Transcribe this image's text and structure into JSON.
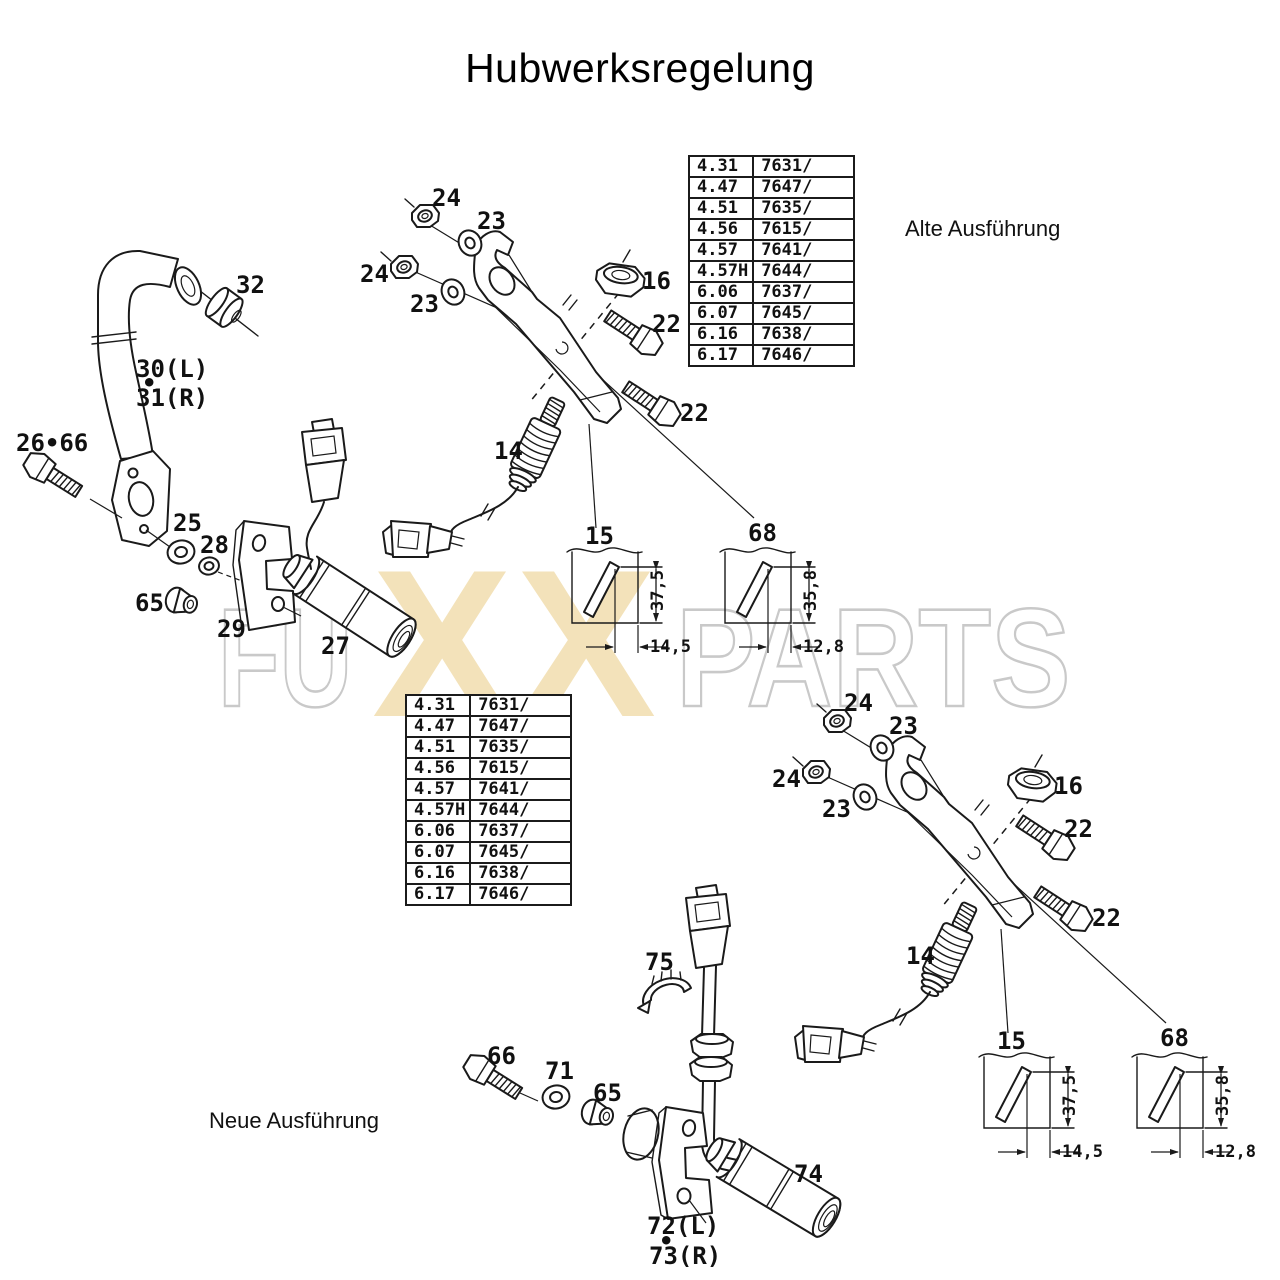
{
  "title": "Hubwerksregelung",
  "annotations": {
    "old_version": "Alte Ausführung",
    "new_version": "Neue Ausführung"
  },
  "variant_table": {
    "rows": [
      [
        "4.31",
        "7631/"
      ],
      [
        "4.47",
        "7647/"
      ],
      [
        "4.51",
        "7635/"
      ],
      [
        "4.56",
        "7615/"
      ],
      [
        "4.57",
        "7641/"
      ],
      [
        "4.57H",
        "7644/"
      ],
      [
        "6.06",
        "7637/"
      ],
      [
        "6.07",
        "7645/"
      ],
      [
        "6.16",
        "7638/"
      ],
      [
        "6.17",
        "7646/"
      ]
    ]
  },
  "watermark": {
    "left": "FU",
    "mid1": "X",
    "mid2": "X",
    "right": "PARTS",
    "tan": "#f3e2ba",
    "gray": "#c9c9c9"
  },
  "line_color": "#1a1a1a",
  "assembly_callouts": [
    {
      "t": "24",
      "x": 432,
      "y": 206,
      "name": "callout-24"
    },
    {
      "t": "23",
      "x": 477,
      "y": 229,
      "name": "callout-23"
    },
    {
      "t": "24",
      "x": 360,
      "y": 282,
      "name": "callout-24"
    },
    {
      "t": "23",
      "x": 410,
      "y": 312,
      "name": "callout-23"
    },
    {
      "t": "16",
      "x": 642,
      "y": 289,
      "name": "callout-16"
    },
    {
      "t": "22",
      "x": 652,
      "y": 332,
      "name": "callout-22"
    },
    {
      "t": "22",
      "x": 680,
      "y": 421,
      "name": "callout-22"
    },
    {
      "t": "14",
      "x": 494,
      "y": 459,
      "name": "callout-14"
    },
    {
      "t": "15",
      "x": 585,
      "y": 544,
      "name": "callout-15"
    },
    {
      "t": "68",
      "x": 748,
      "y": 541,
      "name": "callout-68"
    },
    {
      "t": "37,5",
      "x": 663,
      "y": 611,
      "rot": -90,
      "cls": "dim",
      "name": "dim-37-5"
    },
    {
      "t": "14,5",
      "x": 650,
      "y": 652,
      "cls": "dim",
      "name": "dim-14-5"
    },
    {
      "t": "35,8",
      "x": 816,
      "y": 611,
      "rot": -90,
      "cls": "dim",
      "name": "dim-35-8"
    },
    {
      "t": "12,8",
      "x": 803,
      "y": 652,
      "cls": "dim",
      "name": "dim-12-8"
    }
  ],
  "global_callouts": [
    {
      "t": "32",
      "x": 236,
      "y": 293,
      "name": "callout-32"
    },
    {
      "t": "30(L)",
      "x": 136,
      "y": 377,
      "name": "callout-30L"
    },
    {
      "t": "•",
      "x": 142,
      "y": 391,
      "name": "callout-dot"
    },
    {
      "t": "31(R)",
      "x": 136,
      "y": 406,
      "name": "callout-31R"
    },
    {
      "t": "26•66",
      "x": 16,
      "y": 451,
      "name": "callout-26-66"
    },
    {
      "t": "25",
      "x": 173,
      "y": 531,
      "name": "callout-25"
    },
    {
      "t": "28",
      "x": 200,
      "y": 553,
      "name": "callout-28"
    },
    {
      "t": "65",
      "x": 135,
      "y": 611,
      "name": "callout-65"
    },
    {
      "t": "29",
      "x": 217,
      "y": 637,
      "name": "callout-29"
    },
    {
      "t": "27",
      "x": 321,
      "y": 654,
      "name": "callout-27"
    },
    {
      "t": "75",
      "x": 645,
      "y": 970,
      "name": "callout-75"
    },
    {
      "t": "66",
      "x": 487,
      "y": 1064,
      "name": "callout-66"
    },
    {
      "t": "71",
      "x": 545,
      "y": 1079,
      "name": "callout-71"
    },
    {
      "t": "65",
      "x": 593,
      "y": 1101,
      "name": "callout-65"
    },
    {
      "t": "74",
      "x": 794,
      "y": 1182,
      "name": "callout-74"
    },
    {
      "t": "72(L)",
      "x": 647,
      "y": 1234,
      "name": "callout-72L"
    },
    {
      "t": "•",
      "x": 659,
      "y": 1249,
      "name": "callout-dot"
    },
    {
      "t": "73(R)",
      "x": 649,
      "y": 1264,
      "name": "callout-73R"
    }
  ]
}
